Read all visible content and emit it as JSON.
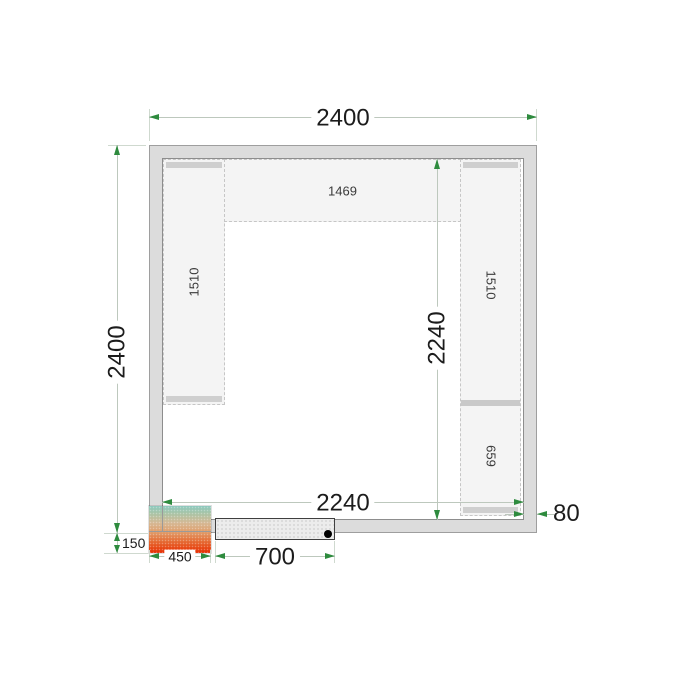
{
  "drawing": {
    "title": "cold-room-floor-plan",
    "dims": {
      "outer_width": "2400",
      "outer_depth": "2400",
      "inner_width": "2240",
      "inner_depth": "2240",
      "wall_thickness": "80",
      "unit_protrusion": "150",
      "unit_width": "450",
      "door_width": "700"
    },
    "shelves": {
      "top": "1469",
      "left": "1510",
      "right_upper": "1510",
      "right_lower": "659"
    },
    "colors": {
      "wall_fill": "#dcdcdc",
      "wall_edge": "#9e9e9e",
      "shelf_fill": "#f4f4f4",
      "shelf_edge": "#c6c6c6",
      "shelf_cap": "#cfcfcf",
      "dim_line": "#bdc8bd",
      "arrow_green": "#2e8b3e",
      "unit_gradient_top": "#8cc9be",
      "unit_gradient_bottom": "#e63005",
      "door_fill": "#ececec",
      "text": "#1c1c1c"
    }
  }
}
